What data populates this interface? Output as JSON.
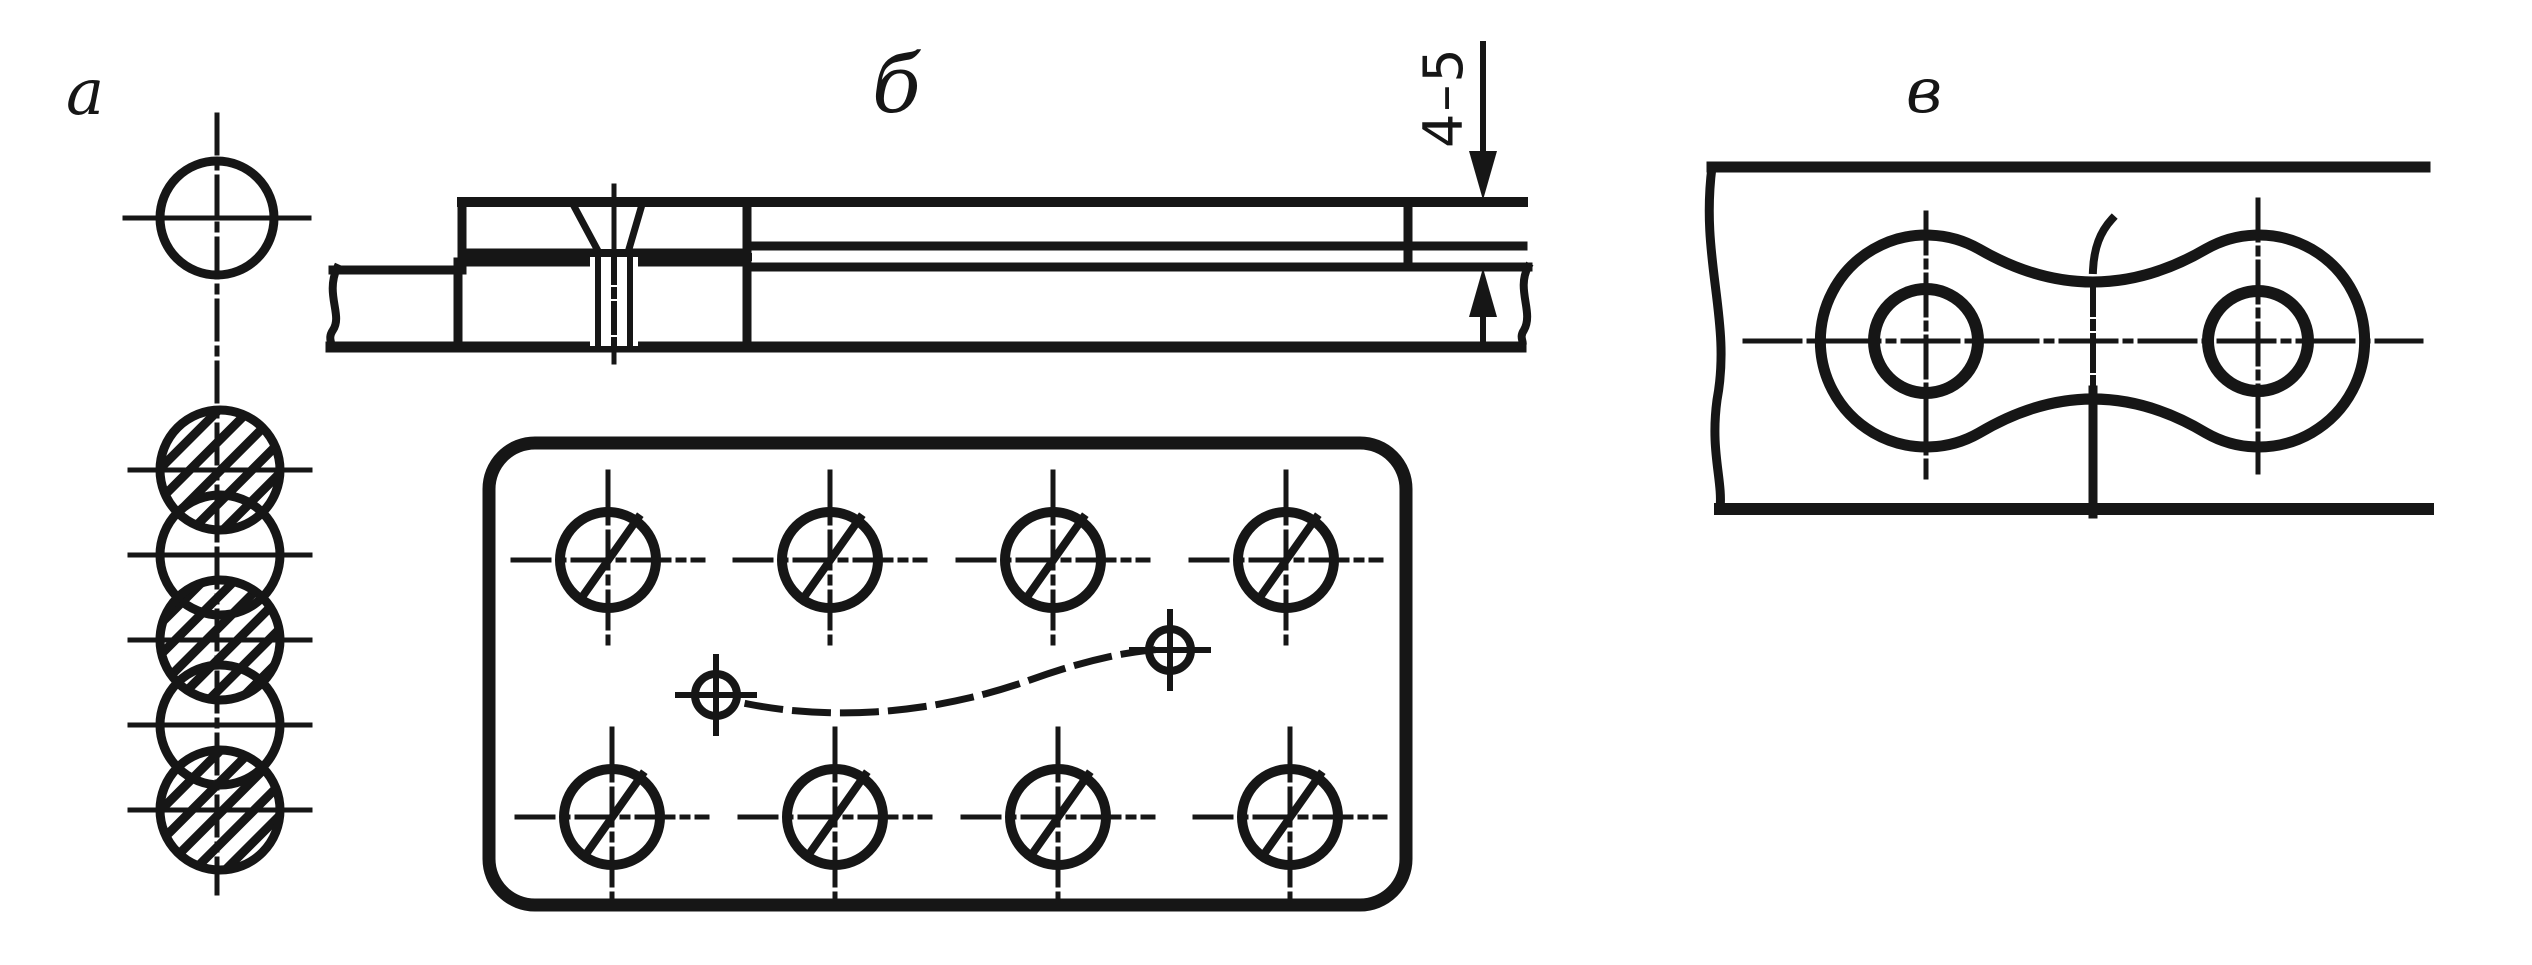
{
  "labels": {
    "a": "а",
    "b": "б",
    "v": "в"
  },
  "dimension": {
    "value": "4–5"
  },
  "colors": {
    "ink": "#161616",
    "paper": "#ffffff"
  },
  "seam_view": {
    "centerline": {
      "x": 217,
      "y1": 115,
      "y2": 893
    },
    "circles": [
      {
        "cx": 217,
        "cy": 218,
        "r": 57,
        "hatched": false,
        "tick": 92
      },
      {
        "cx": 220,
        "cy": 470,
        "r": 60,
        "hatched": true,
        "tick": 90
      },
      {
        "cx": 220,
        "cy": 555,
        "r": 60,
        "hatched": false,
        "tick": 90
      },
      {
        "cx": 220,
        "cy": 640,
        "r": 60,
        "hatched": true,
        "tick": 90
      },
      {
        "cx": 220,
        "cy": 725,
        "r": 60,
        "hatched": false,
        "tick": 90
      },
      {
        "cx": 220,
        "cy": 810,
        "r": 60,
        "hatched": true,
        "tick": 90
      }
    ]
  },
  "plan_view": {
    "spot_radius": 48,
    "spots": [
      {
        "cx": 608,
        "cy": 560
      },
      {
        "cx": 830,
        "cy": 560
      },
      {
        "cx": 1053,
        "cy": 560
      },
      {
        "cx": 1286,
        "cy": 560
      },
      {
        "cx": 612,
        "cy": 817
      },
      {
        "cx": 835,
        "cy": 817
      },
      {
        "cx": 1058,
        "cy": 817
      },
      {
        "cx": 1290,
        "cy": 817
      }
    ],
    "tack_radius": 21,
    "tack_spots": [
      {
        "cx": 716,
        "cy": 695
      },
      {
        "cx": 1170,
        "cy": 650
      }
    ]
  }
}
